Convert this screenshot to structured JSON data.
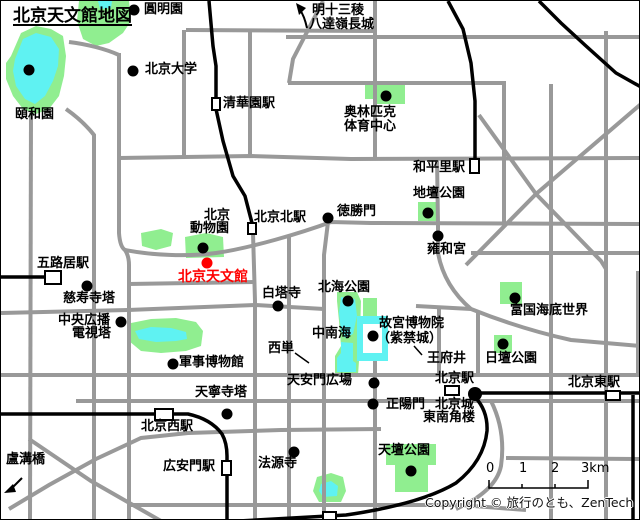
{
  "title": "北京天文館地図",
  "colors": {
    "road": "#999999",
    "railway": "#000000",
    "park_green": "#90EE90",
    "water_cyan": "#5FF2F2",
    "planetarium_red": "#FF0000",
    "station_fill": "#FFFFFF",
    "text": "#000000"
  },
  "direction_note": {
    "line1": "明十三稜",
    "line2": "八達嶺長城"
  },
  "places": {
    "yuanmingyuan": "圓明園",
    "beijing_univ": "北京大学",
    "iwaen": "頤和園",
    "qinghuayuan_station": "清華園駅",
    "olympic_line1": "奥林匹克",
    "olympic_line2": "体育中心",
    "hepingli_station": "和平里駅",
    "ditan_park": "地壇公園",
    "yonghegong": "雍和宮",
    "deshengmen": "徳勝門",
    "beijingbei_station": "北京北駅",
    "zoo_line1": "北京",
    "zoo_line2": "動物園",
    "planetarium": "北京天文館",
    "wuluju_station": "五路居駅",
    "cishousi_pagoda": "慈寿寺塔",
    "tv_tower_line1": "中央広播",
    "tv_tower_line2": "電視塔",
    "military_museum": "軍事博物館",
    "baitasi": "白塔寺",
    "beihai_park": "北海公園",
    "zhongnanhai": "中南海",
    "gugong_line1": "故宮博物院",
    "gugong_line2": "（紫禁城）",
    "wangfujing": "王府井",
    "xidan": "西単",
    "fuguo_undersea": "富国海底世界",
    "ritan_park": "日壇公園",
    "tiananmen_square": "天安門広場",
    "zhengyangmen": "正陽門",
    "beijing_station": "北京駅",
    "corner_tower_line1": "北京城",
    "corner_tower_line2": "東南角楼",
    "beijingdong_station": "北京東駅",
    "tiantan_park": "天壇公園",
    "tianningsi_pagoda": "天寧寺塔",
    "beijingxi_station": "北京西駅",
    "guanganmen_station": "広安門駅",
    "fayuansi": "法源寺",
    "lugouqiao": "盧溝橋"
  },
  "scale_bar": {
    "t0": "0",
    "t1": "1",
    "t2": "2",
    "t3": "3km"
  },
  "copyright": "Copyright © 旅行のとも、ZenTech"
}
